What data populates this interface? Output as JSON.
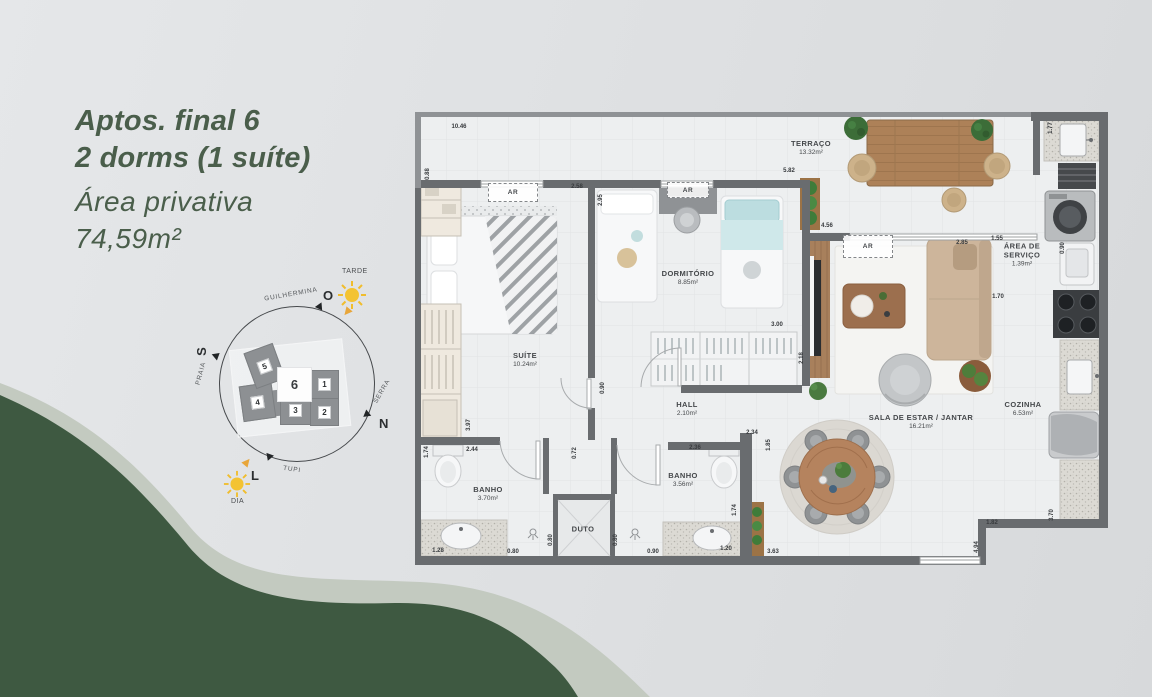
{
  "panel": {
    "title_line1": "Aptos. final 6",
    "title_line2": "2 dorms (1 suíte)",
    "subtitle_line1": "Área privativa",
    "subtitle_line2": "74,59m²"
  },
  "compass": {
    "street_top": "GUILHERMINA",
    "street_left": "PRAIA",
    "street_right": "SERRA",
    "street_bottom": "TUPI",
    "dir_top": "O",
    "dir_left": "S",
    "dir_right": "N",
    "dir_bottom": "L",
    "sun_top_label": "TARDE",
    "sun_bottom_label": "DIA",
    "units": [
      {
        "n": "1",
        "x": 125,
        "y": 112,
        "w": 27,
        "h": 27,
        "rot": 0,
        "active": false
      },
      {
        "n": "2",
        "x": 125,
        "y": 140,
        "w": 27,
        "h": 26,
        "rot": 0,
        "active": false
      },
      {
        "n": "3",
        "x": 95,
        "y": 137,
        "w": 29,
        "h": 28,
        "rot": 0,
        "active": false
      },
      {
        "n": "4",
        "x": 56,
        "y": 126,
        "w": 31,
        "h": 34,
        "rot": -8,
        "active": false
      },
      {
        "n": "5",
        "x": 64,
        "y": 89,
        "w": 29,
        "h": 36,
        "rot": -20,
        "active": false
      },
      {
        "n": "6",
        "x": 92,
        "y": 109,
        "w": 33,
        "h": 33,
        "rot": 0,
        "active": true
      }
    ]
  },
  "plan": {
    "ar_label": "AR",
    "ar_boxes": [
      {
        "x": 73,
        "y": 75,
        "w": 48,
        "h": 17
      },
      {
        "x": 252,
        "y": 74,
        "w": 40,
        "h": 14
      },
      {
        "x": 428,
        "y": 127,
        "w": 48,
        "h": 21
      }
    ],
    "rooms": [
      {
        "name": "TERRAÇO",
        "area": "13.32m²",
        "x": 396,
        "y": 40
      },
      {
        "name": "DORMITÓRIO",
        "area": "8.85m²",
        "x": 273,
        "y": 170
      },
      {
        "name": "SUÍTE",
        "area": "10.24m²",
        "x": 110,
        "y": 252
      },
      {
        "name": "HALL",
        "area": "2.10m²",
        "x": 272,
        "y": 301
      },
      {
        "name": "BANHO",
        "area": "3.70m²",
        "x": 73,
        "y": 386
      },
      {
        "name": "BANHO",
        "area": "3.56m²",
        "x": 268,
        "y": 372
      },
      {
        "name": "DUTO",
        "area": "",
        "x": 168,
        "y": 421
      },
      {
        "name": "SALA DE ESTAR / JANTAR",
        "area": "16.21m²",
        "x": 506,
        "y": 314
      },
      {
        "name": "COZINHA",
        "area": "6.53m²",
        "x": 608,
        "y": 301
      },
      {
        "name": "ÁREA DE\nSERVIÇO",
        "area": "1.39m²",
        "x": 607,
        "y": 147
      }
    ],
    "dims": [
      {
        "v": "10.46",
        "x": 44,
        "y": 19,
        "r": 0
      },
      {
        "v": "0.88",
        "x": 13,
        "y": 66,
        "r": 1
      },
      {
        "v": "2.58",
        "x": 162,
        "y": 79,
        "r": 0
      },
      {
        "v": "2.95",
        "x": 186,
        "y": 92,
        "r": 1
      },
      {
        "v": "5.82",
        "x": 374,
        "y": 63,
        "r": 0
      },
      {
        "v": "1.77",
        "x": 636,
        "y": 20,
        "r": 1
      },
      {
        "v": "4.56",
        "x": 412,
        "y": 118,
        "r": 0
      },
      {
        "v": "2.85",
        "x": 547,
        "y": 135,
        "r": 0
      },
      {
        "v": "1.55",
        "x": 582,
        "y": 131,
        "r": 0
      },
      {
        "v": "0.90",
        "x": 648,
        "y": 140,
        "r": 1
      },
      {
        "v": "1.70",
        "x": 583,
        "y": 189,
        "r": 0
      },
      {
        "v": "3.00",
        "x": 362,
        "y": 217,
        "r": 0
      },
      {
        "v": "2.18",
        "x": 387,
        "y": 250,
        "r": 1
      },
      {
        "v": "0.90",
        "x": 188,
        "y": 280,
        "r": 1
      },
      {
        "v": "3.97",
        "x": 54,
        "y": 317,
        "r": 1
      },
      {
        "v": "2.44",
        "x": 57,
        "y": 342,
        "r": 0
      },
      {
        "v": "1.74",
        "x": 12,
        "y": 344,
        "r": 1
      },
      {
        "v": "0.72",
        "x": 160,
        "y": 345,
        "r": 1
      },
      {
        "v": "2.34",
        "x": 337,
        "y": 325,
        "r": 0
      },
      {
        "v": "2.36",
        "x": 280,
        "y": 340,
        "r": 0
      },
      {
        "v": "1.85",
        "x": 354,
        "y": 337,
        "r": 1
      },
      {
        "v": "1.74",
        "x": 320,
        "y": 402,
        "r": 1
      },
      {
        "v": "1.28",
        "x": 23,
        "y": 443,
        "r": 0
      },
      {
        "v": "0.80",
        "x": 98,
        "y": 444,
        "r": 0
      },
      {
        "v": "0.80",
        "x": 136,
        "y": 432,
        "r": 1
      },
      {
        "v": "0.80",
        "x": 201,
        "y": 432,
        "r": 1
      },
      {
        "v": "0.90",
        "x": 238,
        "y": 444,
        "r": 0
      },
      {
        "v": "1.20",
        "x": 311,
        "y": 441,
        "r": 0
      },
      {
        "v": "3.63",
        "x": 358,
        "y": 444,
        "r": 0
      },
      {
        "v": "1.82",
        "x": 577,
        "y": 415,
        "r": 0
      },
      {
        "v": "3.70",
        "x": 637,
        "y": 407,
        "r": 1
      },
      {
        "v": "4.94",
        "x": 562,
        "y": 439,
        "r": 1
      }
    ]
  }
}
